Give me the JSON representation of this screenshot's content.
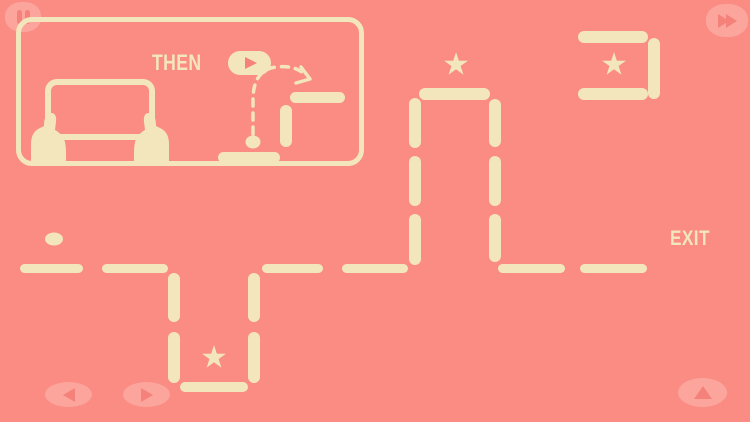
{
  "theme": {
    "background": "#FA8C84",
    "platform_color": "#F3E6BC",
    "button_overlay_color": "#FBA59C",
    "button_glyph_color": "#F5827A",
    "text_color": "#F3E6BC"
  },
  "hud": {
    "pause_button": {
      "icon": "pause-icon"
    },
    "fast_forward_button": {
      "icon": "fast-forward-icon"
    },
    "move_left_button": {
      "icon": "triangle-left-icon"
    },
    "move_right_button": {
      "icon": "triangle-right-icon"
    },
    "jump_button": {
      "icon": "triangle-up-icon"
    }
  },
  "tutorial": {
    "label": "THEN",
    "play_button_icon": "play-icon",
    "illustration": "hands-holding-tilted-device",
    "platforms": [
      {
        "x": 218,
        "y": 152,
        "w": 62,
        "h": 11
      },
      {
        "x": 280,
        "y": 105,
        "w": 12,
        "h": 42
      },
      {
        "x": 290,
        "y": 92,
        "w": 55,
        "h": 11
      }
    ],
    "ball": {
      "x": 253,
      "y": 142,
      "w": 15,
      "h": 13
    }
  },
  "level": {
    "exit_label": "EXIT",
    "platforms": [
      {
        "x": 20,
        "y": 264,
        "w": 63,
        "h": 9
      },
      {
        "x": 102,
        "y": 264,
        "w": 66,
        "h": 9
      },
      {
        "x": 262,
        "y": 264,
        "w": 61,
        "h": 9
      },
      {
        "x": 342,
        "y": 264,
        "w": 66,
        "h": 9
      },
      {
        "x": 498,
        "y": 264,
        "w": 67,
        "h": 9
      },
      {
        "x": 580,
        "y": 264,
        "w": 67,
        "h": 9
      },
      {
        "x": 168,
        "y": 273,
        "w": 12,
        "h": 49
      },
      {
        "x": 168,
        "y": 332,
        "w": 12,
        "h": 51
      },
      {
        "x": 248,
        "y": 273,
        "w": 12,
        "h": 49
      },
      {
        "x": 248,
        "y": 332,
        "w": 12,
        "h": 51
      },
      {
        "x": 180,
        "y": 382,
        "w": 68,
        "h": 10
      },
      {
        "x": 419,
        "y": 88,
        "w": 71,
        "h": 12
      },
      {
        "x": 409,
        "y": 98,
        "w": 12,
        "h": 50
      },
      {
        "x": 409,
        "y": 156,
        "w": 12,
        "h": 50
      },
      {
        "x": 409,
        "y": 214,
        "w": 12,
        "h": 51
      },
      {
        "x": 489,
        "y": 99,
        "w": 12,
        "h": 48
      },
      {
        "x": 489,
        "y": 156,
        "w": 12,
        "h": 50
      },
      {
        "x": 489,
        "y": 214,
        "w": 12,
        "h": 48
      },
      {
        "x": 578,
        "y": 31,
        "w": 70,
        "h": 12
      },
      {
        "x": 648,
        "y": 38,
        "w": 12,
        "h": 61
      },
      {
        "x": 578,
        "y": 88,
        "w": 70,
        "h": 12
      }
    ],
    "stars": [
      {
        "x": 456,
        "y": 65
      },
      {
        "x": 614,
        "y": 65
      },
      {
        "x": 214,
        "y": 358
      }
    ],
    "ball": {
      "x": 54,
      "y": 239,
      "w": 18,
      "h": 13
    }
  }
}
